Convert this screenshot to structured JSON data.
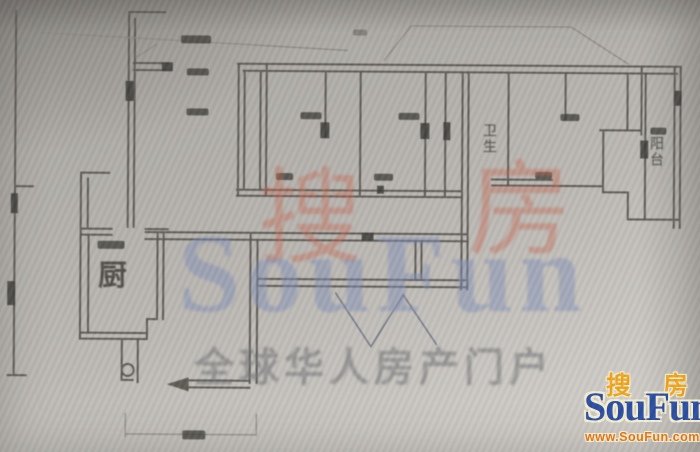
{
  "image": {
    "kind": "scanned apartment floor plan photo",
    "width": 700,
    "height": 452
  },
  "floorplan": {
    "room_labels": [
      {
        "id": "kitchen",
        "text": "厨",
        "orientation": "horizontal"
      },
      {
        "id": "bathroom",
        "text": "卫生",
        "orientation": "vertical"
      },
      {
        "id": "balcony",
        "text": "阳台",
        "orientation": "vertical"
      }
    ]
  },
  "watermark": {
    "char_left": "搜",
    "char_right": "房",
    "latin": "SouFun",
    "slogan": "全球华人房产门户",
    "colors": {
      "chars": "#c66854",
      "latin": "#7f8fb8",
      "slogan": "#707073"
    }
  },
  "logo": {
    "char_left": "搜",
    "char_right": "房",
    "name": "SouFun",
    "url": "www.SouFun.com",
    "colors": {
      "chars": "#f0a521",
      "name": "#2c4fa3",
      "url": "#e2761a",
      "outline": "#f5eed2"
    }
  },
  "palette": {
    "paper": "#b8b5b0",
    "line": "#5f5c56",
    "dark": "#3f3d39"
  }
}
